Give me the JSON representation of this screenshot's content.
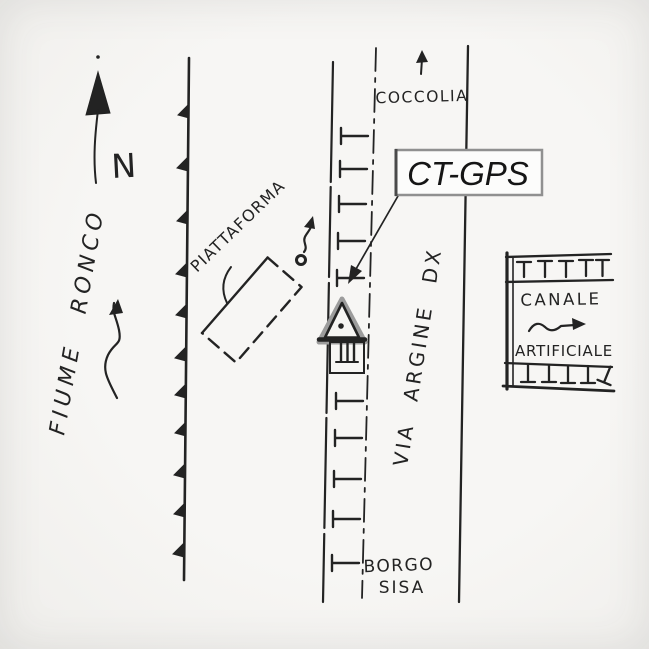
{
  "scene": {
    "description": "Hand-drawn location sketch map of GPS station CT-GPS",
    "paper_color": "#f5f4f1",
    "ink_color": "#222222"
  },
  "compass": {
    "north_label": "N",
    "icon": "north-arrow"
  },
  "river": {
    "name": "FIUME RONCO",
    "flow_icon": "wavy-arrow-up"
  },
  "embankment": {
    "icon": "hachured-line-triangles"
  },
  "platform": {
    "label": "PIATTAFORMA",
    "outline_icon": "dashed-rectangle",
    "marker_icon": "circle-squiggle-arrow"
  },
  "road": {
    "name": "VIA ARGINE DX",
    "destination_north": "COCCOLIA",
    "destination_north_icon": "up-arrow",
    "destination_south_line1": "BORGO",
    "destination_south_line2": "SISA",
    "edge_icon": "t-bar-hachures",
    "centerline_icon": "dash-dot-line"
  },
  "station": {
    "label": "CT-GPS",
    "label_box": {
      "border_color": "#909090",
      "fill": "#fcfcfb",
      "text_color": "#151515"
    },
    "marker_icon": "triangle-with-center-dot",
    "building_icon": "hatched-hut",
    "leader_icon": "arrow-to-marker"
  },
  "canal": {
    "name_line1": "CANALE",
    "name_line2": "ARTIFICIALE",
    "flow_icon": "zigzag-arrow-right",
    "bank_icon": "t-bar-hachures"
  }
}
